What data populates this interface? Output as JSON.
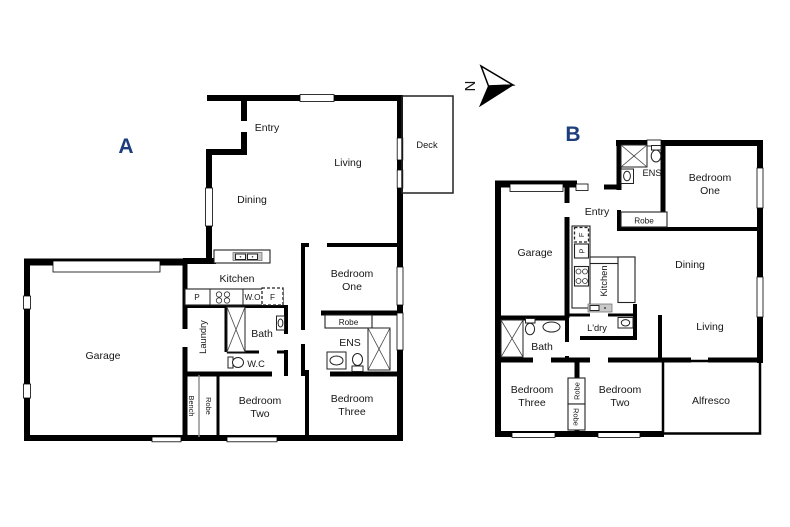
{
  "meta": {
    "background": "#ffffff",
    "wall_color": "#000000",
    "unit_label_color": "#1d3d7d",
    "text_color": "#161616"
  },
  "compass": {
    "north_label": "N"
  },
  "unit_a": {
    "label": "A",
    "rooms": {
      "entry": "Entry",
      "living": "Living",
      "dining": "Dining",
      "deck": "Deck",
      "kitchen": "Kitchen",
      "garage": "Garage",
      "laundry": "Laundry",
      "bath": "Bath",
      "wc": "W.C",
      "bench": "Bench",
      "robe_hall": "Robe",
      "pantry": "P",
      "wall_oven": "W.O",
      "fridge": "F",
      "bed1_l1": "Bedroom",
      "bed1_l2": "One",
      "bed2_l1": "Bedroom",
      "bed2_l2": "Two",
      "bed3_l1": "Bedroom",
      "bed3_l2": "Three",
      "robe_bed1": "Robe",
      "ens": "ENS"
    }
  },
  "unit_b": {
    "label": "B",
    "rooms": {
      "ens": "ENS",
      "bed1_l1": "Bedroom",
      "bed1_l2": "One",
      "entry": "Entry",
      "robe_bed1": "Robe",
      "garage": "Garage",
      "fridge": "F",
      "pantry": "P",
      "kitchen": "Kitchen",
      "dining": "Dining",
      "living": "Living",
      "ldry": "L'dry",
      "bath": "Bath",
      "bed3_l1": "Bedroom",
      "bed3_l2": "Three",
      "robe_top": "Robe",
      "robe_bottom": "Robe",
      "bed2_l1": "Bedroom",
      "bed2_l2": "Two",
      "alfresco": "Alfresco"
    }
  }
}
